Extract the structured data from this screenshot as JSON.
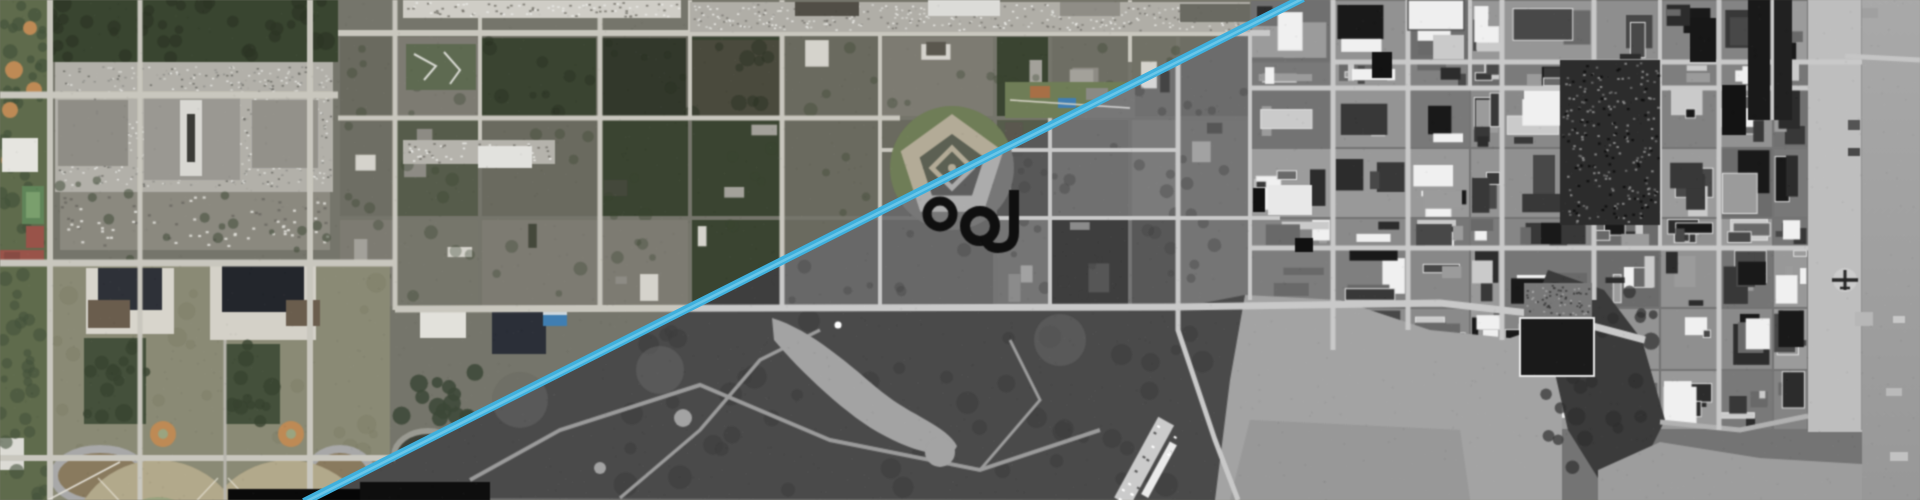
{
  "view": {
    "type": "aerial-imagery-swipe-comparison",
    "width": 1920,
    "height": 500,
    "left_layer_label": "color aerial imagery",
    "right_layer_label": "grayscale aerial imagery"
  },
  "divider": {
    "x_top": 1303,
    "y_top": 0,
    "x_bottom": 304,
    "y_bottom": 500,
    "thickness": 8,
    "color": "#3fb0dd",
    "highlight": "#8fd9f2"
  },
  "palette": {
    "ground_olive": "#75756a",
    "block_olive": "#6e6e63",
    "road_light": "#c9c7be",
    "parking_gray": "#b2b0a9",
    "tree_green": "#39452f",
    "lawn_green": "#6f7d55",
    "campus_tan": "#8a8a74",
    "field_tan": "#b3a989",
    "field_green": "#9aa47e",
    "infield_orange": "#c08a52",
    "building_gray": "#98968f",
    "building_white": "#e8e7e2",
    "roof_dark": "#2e3138",
    "brick_red": "#9c5248",
    "pool_blue": "#3d7fb5",
    "pentagon_beige": "#b3ab96",
    "black_building": "#121212",
    "golf_dark": "#4b4d46",
    "golf_path": "#9b9b93",
    "lake_gray": "#a3a39b",
    "water_gray": "#9c9c9a",
    "shore_dark": "#3c3e38",
    "waterfront_concrete": "#bcbcb8"
  },
  "scene": {
    "features": [
      "shopping-mall-parking-lots",
      "baseball-diamonds",
      "campus-running-tracks",
      "pentagon-shaped-building",
      "black-ring-buildings",
      "golf-course-with-lake",
      "downtown-grid",
      "harbor-waterfront-piers",
      "parked-airplane",
      "marina-docks"
    ]
  }
}
